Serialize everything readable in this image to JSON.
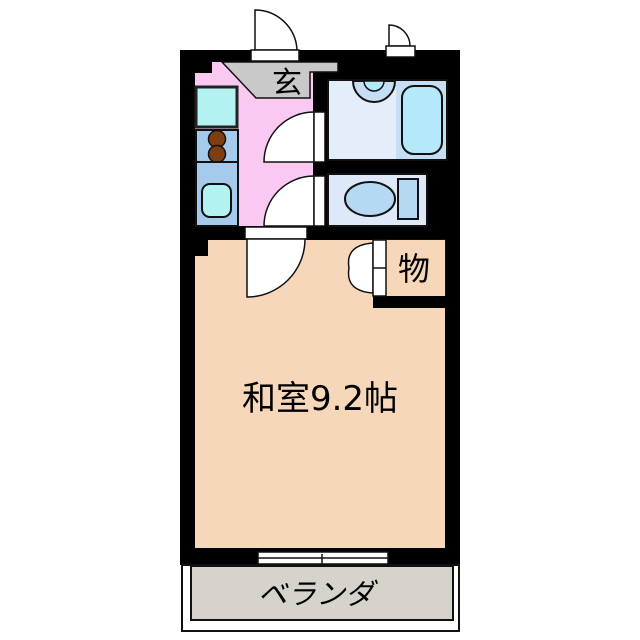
{
  "plan": {
    "type": "japanese-apartment-floorplan",
    "labels": {
      "entrance": "玄",
      "closet": "物",
      "main_room": "和室9.2帖",
      "balcony": "ベランダ"
    },
    "colors": {
      "wall": "#000000",
      "kitchen_floor": "#FAC9F1",
      "entrance_floor": "#C9C9C9",
      "bathroom_floor": "#E4EEFA",
      "bath_surround": "#C6DEF4",
      "bathtub": "#B3E9F8",
      "toilet_floor": "#DDE9F8",
      "toilet_fixture": "#B5D8F3",
      "closet_floor": "#F7A746",
      "main_room_floor": "#F6D7B9",
      "balcony_floor": "#D6D2CC",
      "counter": "#A6CAEB",
      "sink": "#B4F2F2",
      "burner": "#7D3E10",
      "door": "#FFFFFF"
    }
  }
}
